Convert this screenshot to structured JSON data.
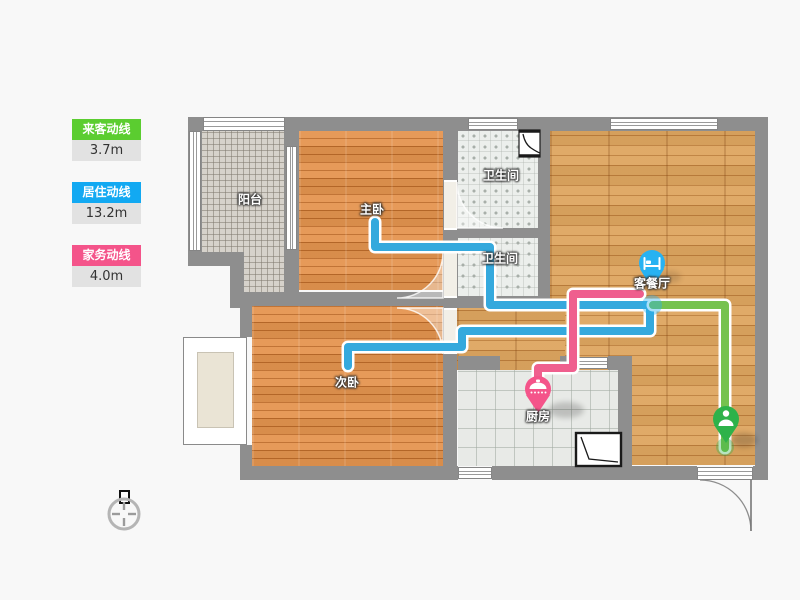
{
  "legend": {
    "items": [
      {
        "id": "visitor",
        "label": "来客动线",
        "value": "3.7m",
        "color": "#5bcd30",
        "line_color": "#76c24f"
      },
      {
        "id": "resident",
        "label": "居住动线",
        "value": "13.2m",
        "color": "#12a9f2",
        "line_color": "#35a9dd"
      },
      {
        "id": "housework",
        "label": "家务动线",
        "value": "4.0m",
        "color": "#f4548a",
        "line_color": "#ef5f8e"
      }
    ]
  },
  "rooms": {
    "balcony": "阳台",
    "master_bedroom": "主卧",
    "bathroom_top": "卫生间",
    "bathroom_mid": "卫生间",
    "living_dining": "客餐厅",
    "second_bedroom": "次卧",
    "kitchen": "厨房"
  },
  "pins": [
    {
      "id": "resident-end",
      "icon": "bed-icon",
      "color": "#27b2f2"
    },
    {
      "id": "housework-end",
      "icon": "cooking-pot-icon",
      "color": "#f4548a"
    },
    {
      "id": "visitor-start",
      "icon": "person-icon",
      "color": "#2eb24a"
    }
  ],
  "compass": {
    "icon": "north-indicator"
  },
  "fixtures": {
    "bathroom": "shower-icon",
    "kitchen": "sink-counter-icon"
  }
}
